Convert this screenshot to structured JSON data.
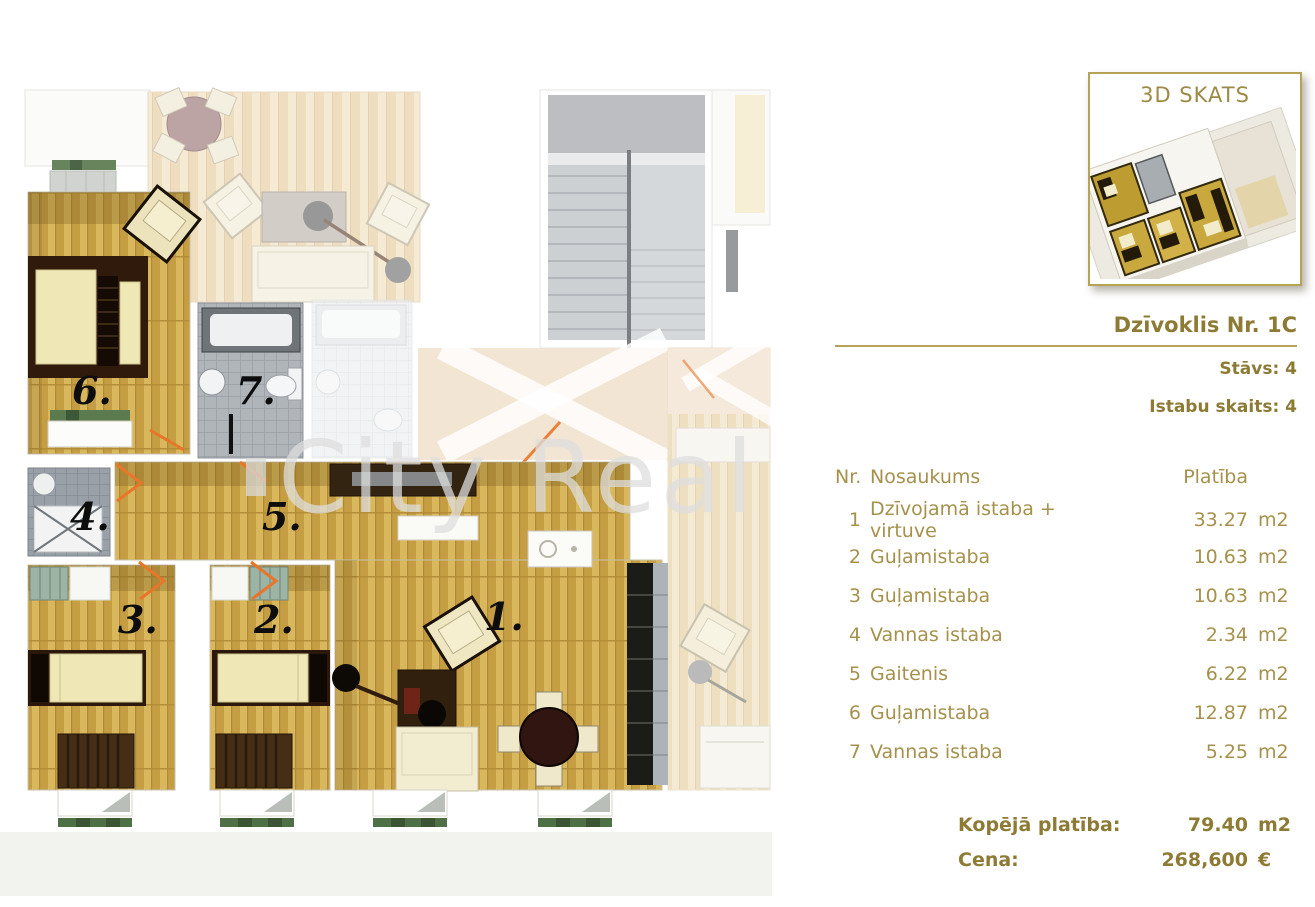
{
  "plan": {
    "watermark": "City Real",
    "labels": {
      "r1": "1.",
      "r2": "2.",
      "r3": "3.",
      "r4": "4.",
      "r5": "5.",
      "r6": "6.",
      "r7": "7."
    }
  },
  "panel": {
    "thumb_label": "3D SKATS",
    "title": "Dzīvoklis Nr. 1C",
    "floor_label": "Stāvs: 4",
    "rooms_label": "Istabu skaits: 4",
    "table": {
      "col_nr": "Nr.",
      "col_name": "Nosaukums",
      "col_area": "Platība",
      "rows": [
        {
          "nr": "1",
          "name": "Dzīvojamā istaba + virtuve",
          "area": "33.27",
          "unit": "m2"
        },
        {
          "nr": "2",
          "name": "Guļamistaba",
          "area": "10.63",
          "unit": "m2"
        },
        {
          "nr": "3",
          "name": "Guļamistaba",
          "area": "10.63",
          "unit": "m2"
        },
        {
          "nr": "4",
          "name": "Vannas istaba",
          "area": "2.34",
          "unit": "m2"
        },
        {
          "nr": "5",
          "name": "Gaitenis",
          "area": "6.22",
          "unit": "m2"
        },
        {
          "nr": "6",
          "name": "Guļamistaba",
          "area": "12.87",
          "unit": "m2"
        },
        {
          "nr": "7",
          "name": "Vannas istaba",
          "area": "5.25",
          "unit": "m2"
        }
      ]
    },
    "totals": {
      "area_label": "Kopējā platība:",
      "area_value": "79.40",
      "area_unit": "m2",
      "price_label": "Cena:",
      "price_value": "268,600",
      "price_unit": "€"
    }
  },
  "colors": {
    "gold": "#a5914c",
    "gold_dark": "#8d7b35",
    "gold_border": "#b5a458",
    "door_orange": "#e8762a"
  }
}
